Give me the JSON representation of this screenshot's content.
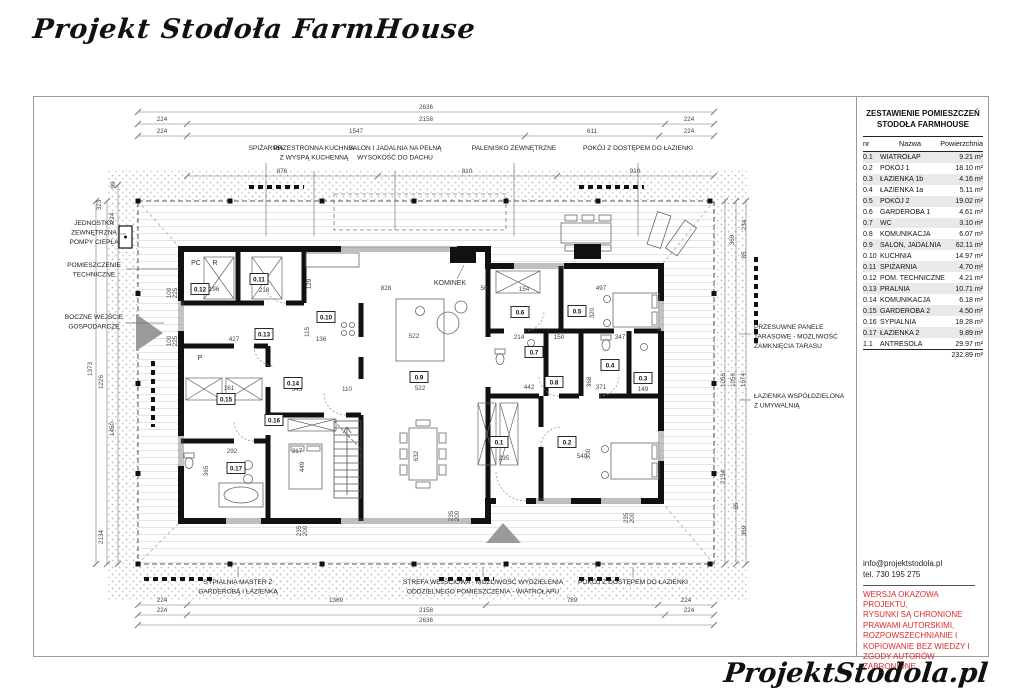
{
  "page": {
    "title": "Projekt Stodoła FarmHouse",
    "footer_logo": "ProjektStodola.pl"
  },
  "room_table": {
    "title_line1": "ZESTAWIENIE POMIESZCZEŃ",
    "title_line2": "STODOŁA FARMHOUSE",
    "columns": [
      "nr",
      "Nazwa",
      "Powierzchnia"
    ],
    "rows": [
      [
        "0.1",
        "WIATROŁAP",
        "9.21 m²"
      ],
      [
        "0.2",
        "POKÓJ 1",
        "18.10 m²"
      ],
      [
        "0.3",
        "ŁAZIENKA 1b",
        "4.16 m²"
      ],
      [
        "0.4",
        "ŁAZIENKA 1a",
        "5.11 m²"
      ],
      [
        "0.5",
        "POKÓJ 2",
        "19.02 m²"
      ],
      [
        "0.6",
        "GARDEROBA 1",
        "4.61 m²"
      ],
      [
        "0.7",
        "WC",
        "3.10 m²"
      ],
      [
        "0.8",
        "KOMUNIKACJA",
        "6.07 m²"
      ],
      [
        "0.9",
        "SALON, JADALNIA",
        "62.11 m²"
      ],
      [
        "0.10",
        "KUCHNIA",
        "14.97 m²"
      ],
      [
        "0.11",
        "SPIŻARNIA",
        "4.70 m²"
      ],
      [
        "0.12",
        "POM. TECHNICZNE",
        "4.21 m²"
      ],
      [
        "0.13",
        "PRALNIA",
        "10.71 m²"
      ],
      [
        "0.14",
        "KOMUNIKACJA",
        "6.18 m²"
      ],
      [
        "0.15",
        "GARDEROBA 2",
        "4.50 m²"
      ],
      [
        "0.16",
        "SYPIALNIA",
        "18.28 m²"
      ],
      [
        "0.17",
        "ŁAZIENKA 2",
        "9.89 m²"
      ],
      [
        "1.1",
        "ANTRESOLA",
        "29.97 m²"
      ]
    ],
    "total": "232.89 m²"
  },
  "contact": {
    "email": "info@projektstodola.pl",
    "phone": "tel. 730 195 275"
  },
  "disclaimer": "WERSJA OKAZOWA PROJEKTU,\nRYSUNKI  SĄ CHRONIONE\nPRAWAMI AUTORSKIMI,\nROZPOWSZECHNIANIE I\nKOPIOWANIE BEZ WIEDZY I\nZGODY AUTORÓW ZABRONIONE.",
  "colors": {
    "accent_red": "#df2b2e",
    "wall": "#111111",
    "line_gray": "#555555"
  },
  "plan": {
    "interior_labels": [
      {
        "t": "PC",
        "x": 162,
        "y": 168
      },
      {
        "t": "R",
        "x": 181,
        "y": 168
      },
      {
        "t": "P",
        "x": 166,
        "y": 263
      },
      {
        "t": "KOMINEK",
        "x": 416,
        "y": 188
      }
    ],
    "room_markers": [
      {
        "id": "0.1",
        "x": 465,
        "y": 345
      },
      {
        "id": "0.2",
        "x": 533,
        "y": 345
      },
      {
        "id": "0.3",
        "x": 609,
        "y": 281
      },
      {
        "id": "0.4",
        "x": 576,
        "y": 268
      },
      {
        "id": "0.5",
        "x": 543,
        "y": 214
      },
      {
        "id": "0.6",
        "x": 486,
        "y": 215
      },
      {
        "id": "0.7",
        "x": 500,
        "y": 255
      },
      {
        "id": "0.8",
        "x": 520,
        "y": 285
      },
      {
        "id": "0.9",
        "x": 385,
        "y": 280
      },
      {
        "id": "0.10",
        "x": 292,
        "y": 220
      },
      {
        "id": "0.11",
        "x": 225,
        "y": 182
      },
      {
        "id": "0.12",
        "x": 166,
        "y": 192
      },
      {
        "id": "0.13",
        "x": 230,
        "y": 237
      },
      {
        "id": "0.14",
        "x": 259,
        "y": 286
      },
      {
        "id": "0.15",
        "x": 192,
        "y": 302
      },
      {
        "id": "0.16",
        "x": 240,
        "y": 323
      },
      {
        "id": "0.17",
        "x": 202,
        "y": 371
      }
    ],
    "dim_labels": [
      {
        "t": "2636",
        "x": 392,
        "y": 12
      },
      {
        "t": "224",
        "x": 128,
        "y": 24
      },
      {
        "t": "2158",
        "x": 392,
        "y": 24
      },
      {
        "t": "224",
        "x": 655,
        "y": 24
      },
      {
        "t": "224",
        "x": 128,
        "y": 36
      },
      {
        "t": "1547",
        "x": 322,
        "y": 36
      },
      {
        "t": "611",
        "x": 558,
        "y": 36
      },
      {
        "t": "224",
        "x": 655,
        "y": 36
      },
      {
        "t": "876",
        "x": 248,
        "y": 76
      },
      {
        "t": "810",
        "x": 433,
        "y": 76
      },
      {
        "t": "910",
        "x": 601,
        "y": 76
      },
      {
        "t": "224",
        "x": 128,
        "y": 505
      },
      {
        "t": "1369",
        "x": 302,
        "y": 505
      },
      {
        "t": "789",
        "x": 538,
        "y": 505
      },
      {
        "t": "224",
        "x": 652,
        "y": 505
      },
      {
        "t": "224",
        "x": 128,
        "y": 515
      },
      {
        "t": "2158",
        "x": 392,
        "y": 515
      },
      {
        "t": "224",
        "x": 655,
        "y": 515
      },
      {
        "t": "2636",
        "x": 392,
        "y": 525
      },
      {
        "t": "99",
        "x": 81,
        "y": 88,
        "r": -90
      },
      {
        "t": "323",
        "x": 67,
        "y": 108,
        "r": -90
      },
      {
        "t": "224",
        "x": 80,
        "y": 121,
        "r": -90
      },
      {
        "t": "1373",
        "x": 58,
        "y": 272,
        "r": -90
      },
      {
        "t": "1226",
        "x": 69,
        "y": 285,
        "r": -90
      },
      {
        "t": "1450",
        "x": 80,
        "y": 332,
        "r": -90
      },
      {
        "t": "2134",
        "x": 69,
        "y": 440,
        "r": -90
      },
      {
        "t": "234",
        "x": 712,
        "y": 128,
        "r": -90
      },
      {
        "t": "369",
        "x": 700,
        "y": 143,
        "r": -90
      },
      {
        "t": "85",
        "x": 712,
        "y": 158,
        "r": -90
      },
      {
        "t": "1056",
        "x": 691,
        "y": 283,
        "r": -90
      },
      {
        "t": "1056",
        "x": 701,
        "y": 283,
        "r": -90
      },
      {
        "t": "1674",
        "x": 711,
        "y": 283,
        "r": -90
      },
      {
        "t": "2134",
        "x": 691,
        "y": 380,
        "r": -90
      },
      {
        "t": "85",
        "x": 704,
        "y": 409,
        "r": -90
      },
      {
        "t": "369",
        "x": 712,
        "y": 434,
        "r": -90
      },
      {
        "t": "218",
        "x": 230,
        "y": 195
      },
      {
        "t": "196",
        "x": 180,
        "y": 194
      },
      {
        "t": "427",
        "x": 200,
        "y": 244
      },
      {
        "t": "136",
        "x": 287,
        "y": 244
      },
      {
        "t": "828",
        "x": 352,
        "y": 193
      },
      {
        "t": "522",
        "x": 380,
        "y": 241
      },
      {
        "t": "522",
        "x": 386,
        "y": 293
      },
      {
        "t": "343",
        "x": 263,
        "y": 294
      },
      {
        "t": "110",
        "x": 313,
        "y": 294
      },
      {
        "t": "161",
        "x": 195,
        "y": 293
      },
      {
        "t": "292",
        "x": 198,
        "y": 356
      },
      {
        "t": "317",
        "x": 263,
        "y": 356
      },
      {
        "t": "365",
        "x": 174,
        "y": 374,
        "r": -90
      },
      {
        "t": "449",
        "x": 270,
        "y": 370,
        "r": -90
      },
      {
        "t": "235",
        "x": 470,
        "y": 363
      },
      {
        "t": "540",
        "x": 548,
        "y": 361
      },
      {
        "t": "300",
        "x": 556,
        "y": 357,
        "r": -90
      },
      {
        "t": "632",
        "x": 384,
        "y": 359,
        "r": -90
      },
      {
        "t": "497",
        "x": 567,
        "y": 193
      },
      {
        "t": "320",
        "x": 560,
        "y": 216,
        "r": -90
      },
      {
        "t": "347",
        "x": 586,
        "y": 242
      },
      {
        "t": "150",
        "x": 525,
        "y": 242
      },
      {
        "t": "214",
        "x": 485,
        "y": 242
      },
      {
        "t": "442",
        "x": 495,
        "y": 292
      },
      {
        "t": "371",
        "x": 567,
        "y": 292
      },
      {
        "t": "149",
        "x": 609,
        "y": 294
      },
      {
        "t": "368",
        "x": 557,
        "y": 285,
        "r": -90
      },
      {
        "t": "129",
        "x": 277,
        "y": 187,
        "r": -90
      },
      {
        "t": "115",
        "x": 275,
        "y": 235,
        "r": -90
      },
      {
        "t": "154",
        "x": 490,
        "y": 194
      },
      {
        "t": "50",
        "x": 450,
        "y": 193
      },
      {
        "t": "100",
        "x": 137,
        "y": 196,
        "r": -90
      },
      {
        "t": "225",
        "x": 143,
        "y": 196,
        "r": -90
      },
      {
        "t": "100",
        "x": 137,
        "y": 244,
        "r": -90
      },
      {
        "t": "225",
        "x": 143,
        "y": 244,
        "r": -90
      },
      {
        "t": "235",
        "x": 419,
        "y": 419,
        "r": -90
      },
      {
        "t": "200",
        "x": 425,
        "y": 419,
        "r": -90
      },
      {
        "t": "235",
        "x": 594,
        "y": 421,
        "r": -90
      },
      {
        "t": "200",
        "x": 600,
        "y": 421,
        "r": -90
      },
      {
        "t": "235",
        "x": 267,
        "y": 434,
        "r": -90
      },
      {
        "t": "200",
        "x": 273,
        "y": 434,
        "r": -90
      }
    ],
    "callouts": [
      {
        "lines": [
          "SPIŻARNIA"
        ],
        "x": 232,
        "y": 53,
        "anchor": "middle",
        "leader": [
          232,
          66,
          232,
          139
        ]
      },
      {
        "lines": [
          "PRZESTRONNA KUCHNIA",
          "Z WYSPĄ KUCHENNĄ"
        ],
        "x": 280,
        "y": 53,
        "anchor": "middle",
        "leader": [
          280,
          74,
          280,
          139
        ]
      },
      {
        "lines": [
          "SALON I JADALNIA NA PEŁNĄ",
          "WYSOKOŚĆ DO DACHU"
        ],
        "x": 361,
        "y": 53,
        "anchor": "middle",
        "leader": [
          361,
          74,
          361,
          133
        ]
      },
      {
        "lines": [
          "PALENISKO ZEWNĘTRZNE"
        ],
        "x": 480,
        "y": 53,
        "anchor": "middle",
        "leader": [
          480,
          66,
          480,
          139
        ]
      },
      {
        "lines": [
          "POKÓJ Z DOSTĘPEM DO ŁAZIENKI"
        ],
        "x": 604,
        "y": 53,
        "anchor": "middle",
        "leader": [
          604,
          66,
          604,
          139
        ]
      },
      {
        "lines": [
          "JEDNOSTKA",
          "ZEWNĘTRZNA",
          "POMPY CIEPŁA"
        ],
        "x": 60,
        "y": 128,
        "anchor": "middle",
        "leader": [
          84,
          137,
          92,
          137
        ]
      },
      {
        "lines": [
          "POMIESZCZENIE",
          "TECHNICZNE"
        ],
        "x": 60,
        "y": 170,
        "anchor": "middle",
        "leader": [
          92,
          172,
          145,
          172
        ]
      },
      {
        "lines": [
          "BOCZNE WEJŚCIE",
          "GOSPODARCZE"
        ],
        "x": 60,
        "y": 222,
        "anchor": "middle",
        "leader": [
          92,
          226,
          130,
          226
        ]
      },
      {
        "lines": [
          "PRZESUWNE PANELE",
          "TARASOWE - MOŻLIWOŚĆ",
          "ZAMKNIĘCIA TARASU"
        ],
        "x": 720,
        "y": 232,
        "anchor": "start",
        "leader": [
          705,
          237,
          717,
          237
        ]
      },
      {
        "lines": [
          "ŁAZIENKA WSPÓŁDZIELONA",
          "Z UMYWALNIĄ"
        ],
        "x": 720,
        "y": 301,
        "anchor": "start",
        "leader": [
          705,
          303,
          717,
          303
        ]
      },
      {
        "lines": [
          "SYPIALNIA MASTER Z",
          "GARDEROBĄ I ŁAZIENKĄ"
        ],
        "x": 204,
        "y": 487,
        "anchor": "middle",
        "leader": [
          204,
          470,
          204,
          480
        ]
      },
      {
        "lines": [
          "STREFA WEJŚCIOWA - MOŻLIWOŚĆ WYDZIELENIA",
          "ODDZIELNEGO POMIESZCZENIA - WIATROŁAPU"
        ],
        "x": 449,
        "y": 487,
        "anchor": "middle",
        "leader": [
          449,
          470,
          449,
          480
        ]
      },
      {
        "lines": [
          "POKÓJ Z DOSTĘPEM DO ŁAZIENKI"
        ],
        "x": 599,
        "y": 487,
        "anchor": "middle",
        "leader": [
          599,
          470,
          599,
          480
        ]
      }
    ]
  }
}
